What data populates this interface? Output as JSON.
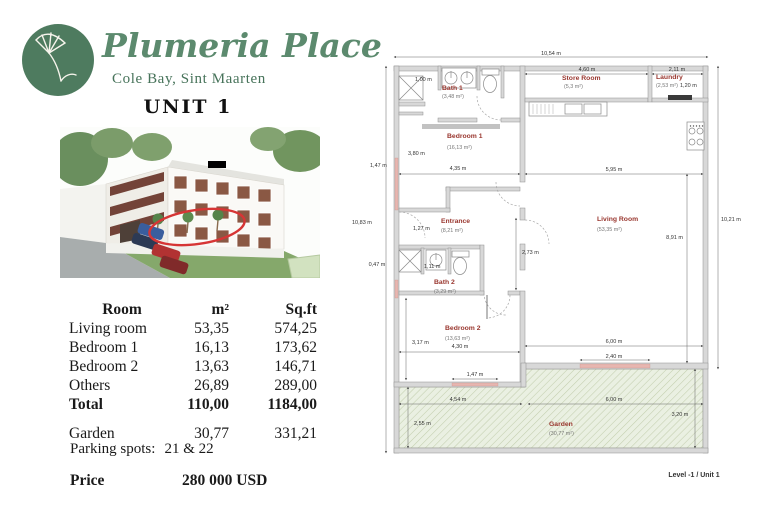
{
  "header": {
    "brand": "Plumeria Place",
    "location": "Cole Bay, Sint Maarten",
    "unit_title": "UNIT 1"
  },
  "area_table": {
    "headers": [
      "Room",
      "m²",
      "Sq.ft"
    ],
    "rows": [
      {
        "room": "Living room",
        "m2": "53,35",
        "sqft": "574,25"
      },
      {
        "room": "Bedroom 1",
        "m2": "16,13",
        "sqft": "173,62"
      },
      {
        "room": "Bedroom 2",
        "m2": "13,63",
        "sqft": "146,71"
      },
      {
        "room": "Others",
        "m2": "26,89",
        "sqft": "289,00"
      },
      {
        "room": "Total",
        "m2": "110,00",
        "sqft": "1184,00"
      }
    ],
    "garden_row": {
      "room": "Garden",
      "m2": "30,77",
      "sqft": "331,21"
    }
  },
  "details": {
    "parking_label": "Parking spots:",
    "parking_value": "21 & 22",
    "price_label": "Price",
    "price_value": "280 000 USD"
  },
  "floorplan": {
    "footer": "Level -1 / Unit 1",
    "rooms": {
      "bath1": {
        "name": "Bath 1",
        "area": "(3,48 m²)"
      },
      "bedroom1": {
        "name": "Bedroom 1",
        "area": "(16,13 m²)"
      },
      "store": {
        "name": "Store Room",
        "area": "(5,3 m²)"
      },
      "laundry": {
        "name": "Laundry",
        "area": "(2,53 m²)"
      },
      "living": {
        "name": "Living Room",
        "area": "(53,35 m²)"
      },
      "entrance": {
        "name": "Entrance",
        "area": "(8,21 m²)"
      },
      "bath2": {
        "name": "Bath 2",
        "area": "(3,29 m²)"
      },
      "bedroom2": {
        "name": "Bedroom 2",
        "area": "(13,63 m²)"
      },
      "garden": {
        "name": "Garden",
        "area": "(30,77 m²)"
      }
    },
    "dims": {
      "top_total": "10,54 m",
      "left_total": "10,83 m",
      "right_total": "10,21 m",
      "store_width": "4,60 m",
      "laundry_width": "2,11 m",
      "laundry_depth": "1,20 m",
      "shower_width": "1,00 m",
      "bed1_height": "3,80 m",
      "bed1_width": "4,35 m",
      "window_left": "1,47 m",
      "living_width": "5,95 m",
      "living_height": "8,91 m",
      "entrance_width": "1,27 m",
      "hall_height": "2,73 m",
      "left_small": "0,47 m",
      "bath2_width": "1,11 m",
      "bed2_height": "3,17 m",
      "bed2_width": "4,30 m",
      "bed2_window": "1,47 m",
      "living_bottom": "6,00 m",
      "living_door": "2,40 m",
      "garden_left": "4,54 m",
      "garden_left_height": "2,55 m",
      "garden_right": "6,00 m",
      "garden_right_height": "3,20 m"
    },
    "colors": {
      "room_label": "#99362e",
      "garden_fill": "#eaf0e2",
      "wall_fill": "#d8d8d8",
      "window": "#e7b6b0",
      "annotation": "#d63535",
      "brand_green": "#5c8a6e"
    }
  }
}
